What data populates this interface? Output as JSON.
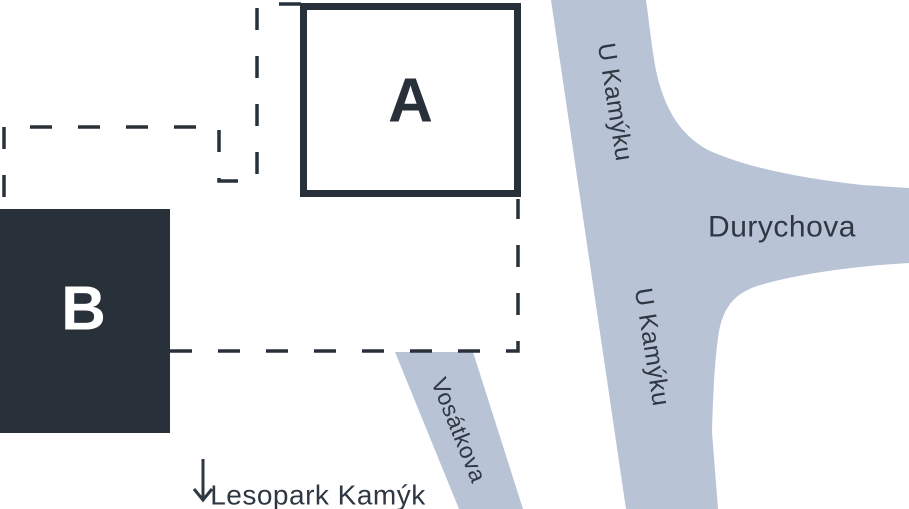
{
  "colors": {
    "road": "#b8c3d6",
    "dark": "#28313a",
    "label_text": "#2e3842",
    "background": "#ffffff",
    "building_b_label": "#ffffff"
  },
  "buildings": {
    "a": {
      "label": "A"
    },
    "b": {
      "label": "B"
    }
  },
  "streets": {
    "u_kamyku_upper": {
      "name": "U Kamýku"
    },
    "u_kamyku_lower": {
      "name": "U Kamýku"
    },
    "durychova": {
      "name": "Durychova"
    },
    "vosatkova": {
      "name": "Vosátkova"
    }
  },
  "landmark": {
    "arrow_icon": "down-arrow",
    "label": "Lesopark Kamýk"
  }
}
